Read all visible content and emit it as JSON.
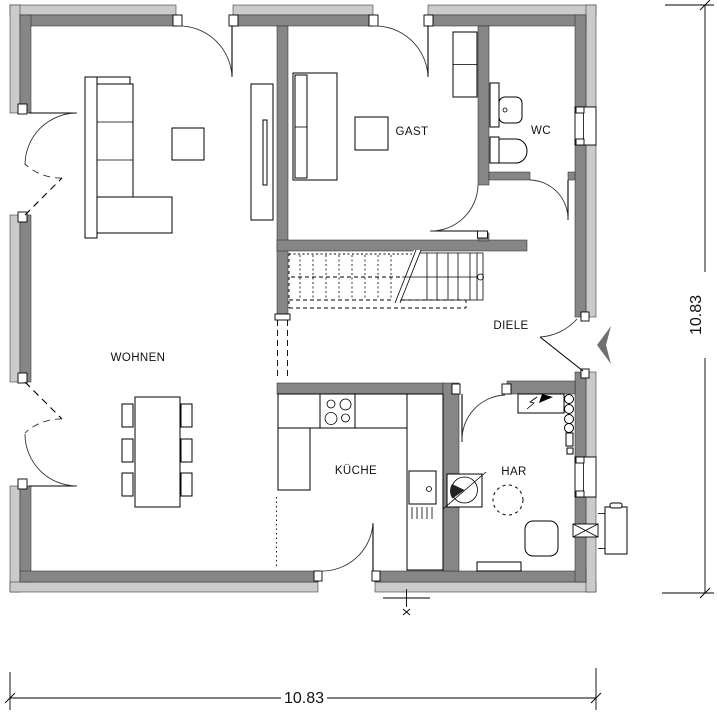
{
  "plan": {
    "rooms": [
      {
        "id": "wohnen",
        "label": "WOHNEN"
      },
      {
        "id": "gast",
        "label": "GAST"
      },
      {
        "id": "wc",
        "label": "WC"
      },
      {
        "id": "diele",
        "label": "DIELE"
      },
      {
        "id": "kueche",
        "label": "KÜCHE"
      },
      {
        "id": "har",
        "label": "HAR"
      }
    ],
    "dimensions": {
      "bottom_width": "10.83",
      "right_height": "10.83"
    },
    "colors": {
      "wall_outer_band": "#cbcbcb",
      "wall_inner_band": "#868686",
      "line": "#000000",
      "entrance_marker": "#6f6f6f"
    },
    "fixtures": [
      "sofa",
      "coffee-table",
      "tv-board",
      "dining-table",
      "dining-chairs",
      "bed",
      "side-table",
      "wardrobe",
      "washbasin",
      "toilet",
      "kitchen-counter",
      "cooktop",
      "kitchen-sink",
      "staircase",
      "washing-machine",
      "distribution-board",
      "meter-assembly",
      "storage-tank",
      "wall-sleeve",
      "heat-pump-unit",
      "entrance-arrow",
      "level-marker"
    ]
  }
}
